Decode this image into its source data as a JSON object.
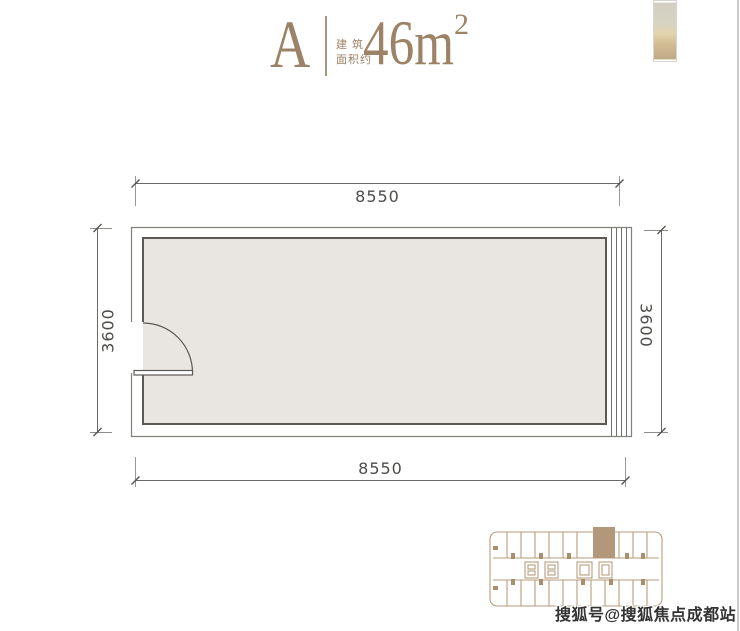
{
  "page": {
    "width": 740,
    "height": 631
  },
  "colors": {
    "accent": "#9c8266",
    "floor_fill": "#e9e5e0",
    "wall_dark": "#5b5954",
    "wall_light": "#83817c",
    "window_line": "#716f6b",
    "dim_line": "#6b6965",
    "dim_text": "#4f4d4a",
    "keyplan_outline": "#b79d7e",
    "keyplan_highlight": "#b2977a",
    "keyplan_tick": "#a98f6e",
    "watermark": "#333333",
    "photo_top": "#d2d0c3",
    "photo_mid": "#e2d4ab",
    "photo_bottom": "#bfa884",
    "edge_line": "#cbcbcb"
  },
  "header": {
    "unit": "A",
    "caption_line1": "建 筑",
    "caption_line2": "面积约",
    "area_value": "46m",
    "area_sup": "2"
  },
  "floorplan": {
    "dims": {
      "top": "8550",
      "bottom": "8550",
      "left": "3600",
      "right": "3600"
    }
  },
  "watermark": {
    "text": "搜狐号@搜狐焦点成都站"
  }
}
